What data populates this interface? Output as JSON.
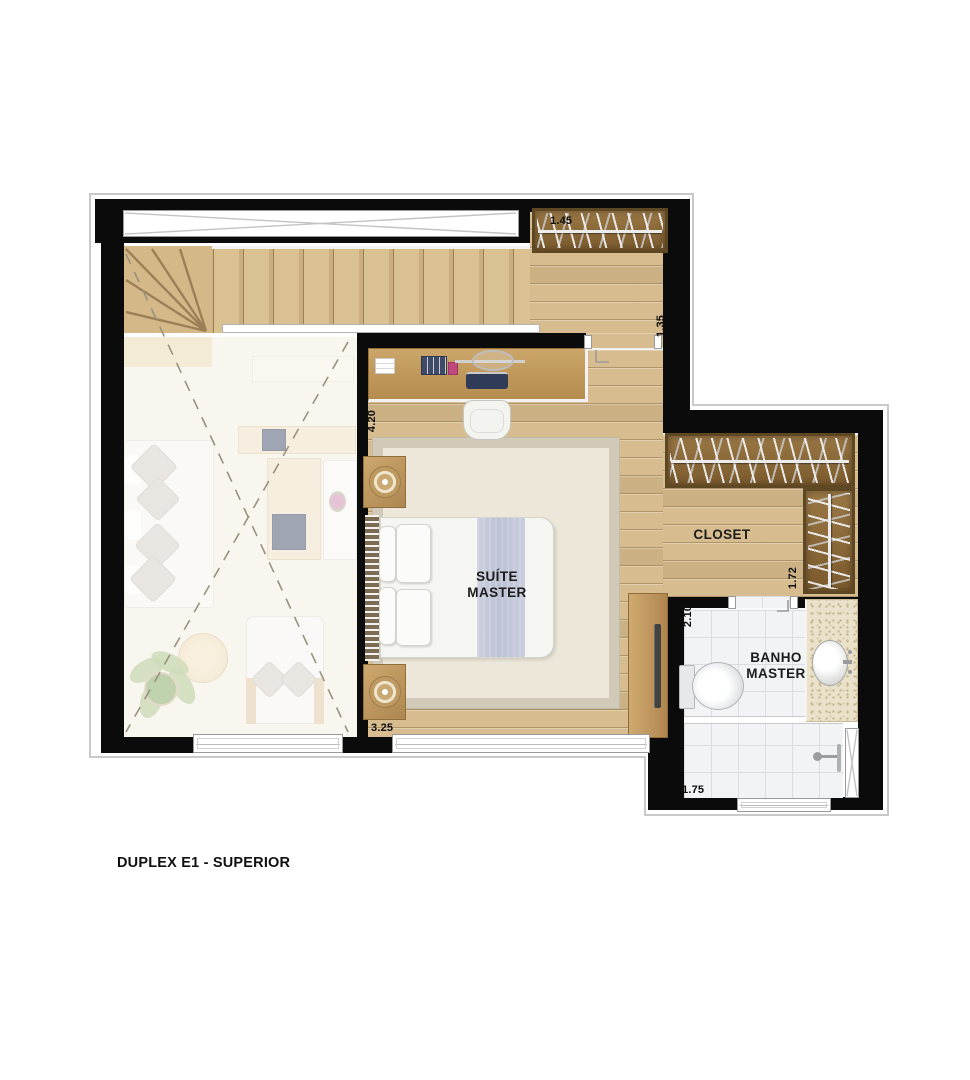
{
  "plan_title": "DUPLEX E1 - SUPERIOR",
  "rooms": {
    "suite": {
      "line1": "SUÍTE",
      "line2": "MASTER"
    },
    "closet": {
      "label": "CLOSET"
    },
    "banho": {
      "line1": "BANHO",
      "line2": "MASTER"
    }
  },
  "dimensions": {
    "entry_rack_width": "1.45",
    "hall_width": "1.35",
    "suite_depth": "4.20",
    "closet_rack_depth": "1.72",
    "banho_depth": "2.10",
    "suite_width": "3.25",
    "banho_width": "1.75"
  },
  "colors": {
    "wall": "#0b0b0b",
    "wood_floor": "#d6bc8e",
    "wood_dark": "#9c7f53",
    "rack_wood": "#8a6837",
    "rug": "#ebe6d8",
    "bathroom_tile": "#f2f3f5",
    "granite": "#e9e1ca",
    "blanket": "#c3c8d8",
    "label_text": "#111111"
  }
}
